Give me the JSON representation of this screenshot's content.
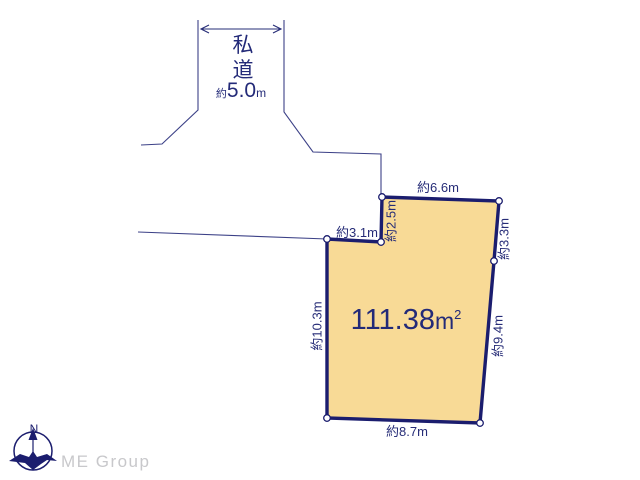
{
  "colors": {
    "outline": "#1b1d6e",
    "text": "#262c77",
    "thin_line": "#3c4187",
    "parcel_fill": "#f8da96",
    "logo_gray": "#c8c8cb"
  },
  "road": {
    "label_char1": "私",
    "label_char2": "道",
    "width_prefix": "約",
    "width_value": "5.0",
    "width_unit": "m"
  },
  "parcel": {
    "area_value": "111.38",
    "area_unit": "m",
    "area_exponent": "2",
    "dims": {
      "top": "約6.6m",
      "notch_v": "約2.5m",
      "notch_h": "約3.1m",
      "right_upper": "約3.3m",
      "right_lower": "約9.4m",
      "bottom": "約8.7m",
      "left": "約10.3m"
    }
  },
  "compass": {
    "north": "N"
  },
  "logo": {
    "text": "ME Group"
  }
}
